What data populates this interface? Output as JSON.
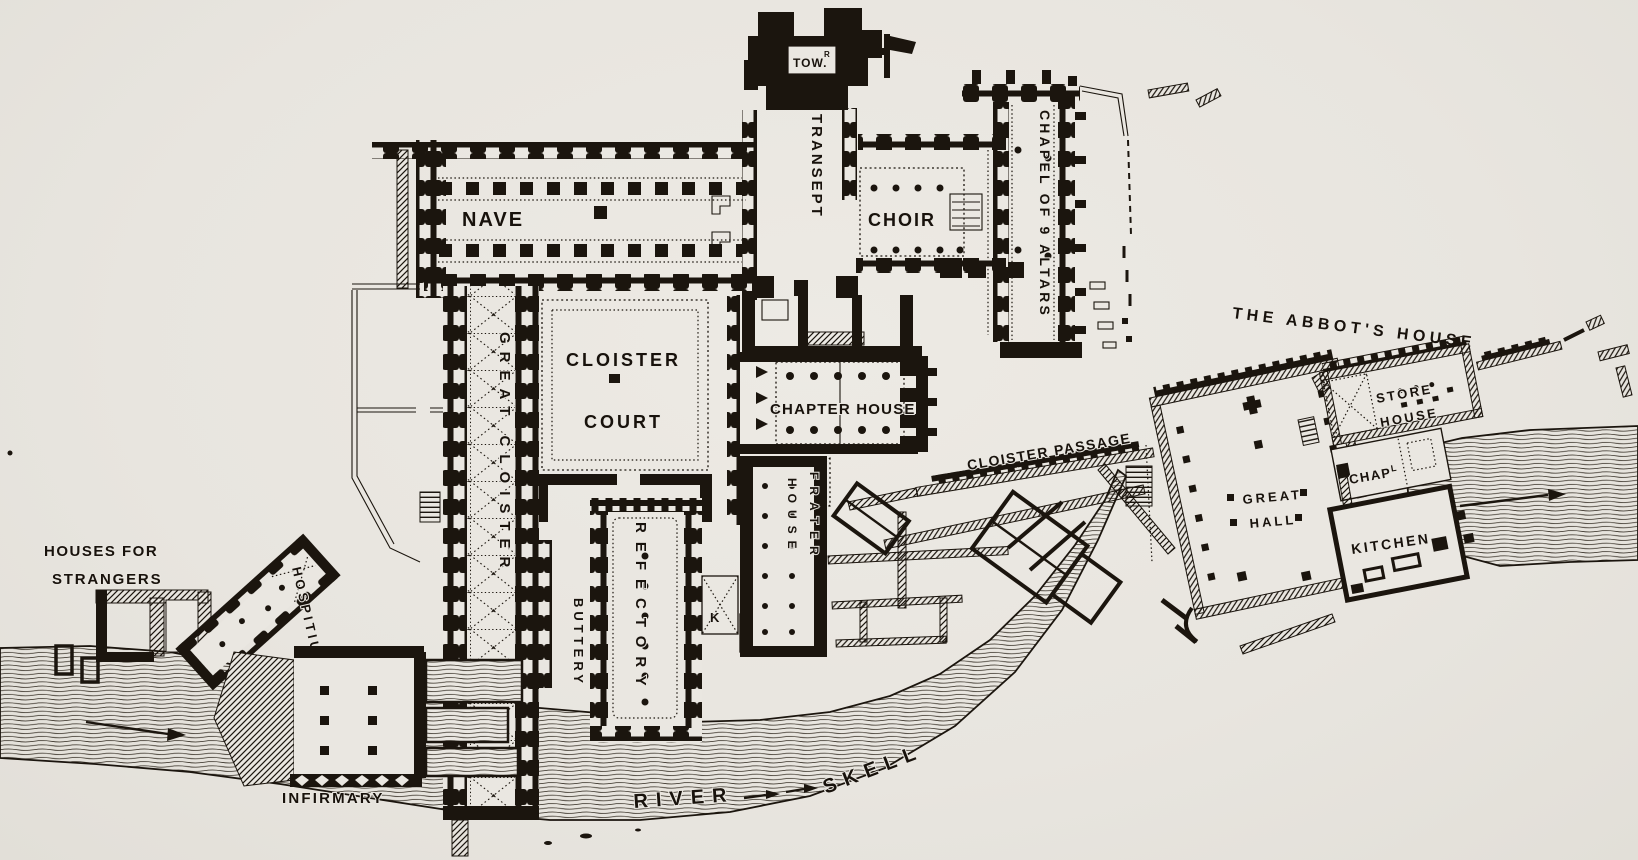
{
  "document": {
    "kind": "engraved ground plan",
    "subject": "Cistercian abbey precinct crossed by a river",
    "paper_color": "#eae7e1",
    "ink_color": "#1b150e"
  },
  "church": {
    "nave": "NAVE",
    "tower": "TOW.",
    "tower_superscript": "R",
    "transept": "TRANSEPT",
    "choir": "CHOIR",
    "chapel_of_nine_altars": "CHAPEL OF 9 ALTARS"
  },
  "cloister": {
    "court_line1": "CLOISTER",
    "court_line2": "COURT",
    "great_cloister": "GREAT CLOISTER",
    "chapter_house": "CHAPTER HOUSE",
    "cloister_passage": "CLOISTER PASSAGE"
  },
  "domestic": {
    "buttery": "BUTTERY",
    "refectory": "REFECTORY",
    "frater_house_line1": "FRATER",
    "frater_house_line2": "HOUSE",
    "kitchen_mark": "K"
  },
  "abbots_house": {
    "title": "THE ABBOT'S HOUSE",
    "great_hall_line1": "GREAT",
    "great_hall_line2": "HALL",
    "store_house_line1": "STORE",
    "store_house_line2": "HOUSE",
    "chapel_abbr": "CHAP",
    "chapel_abbr_superscript": "L",
    "kitchen": "KITCHEN"
  },
  "outer_buildings": {
    "houses_for_strangers_line1": "HOUSES FOR",
    "houses_for_strangers_line2": "STRANGERS",
    "hospitium": "HOSPITIUM",
    "infirmary": "INFIRMARY"
  },
  "river": {
    "label_word1": "RIVER",
    "label_word2": "SKELL",
    "flow_direction": "west to east"
  }
}
